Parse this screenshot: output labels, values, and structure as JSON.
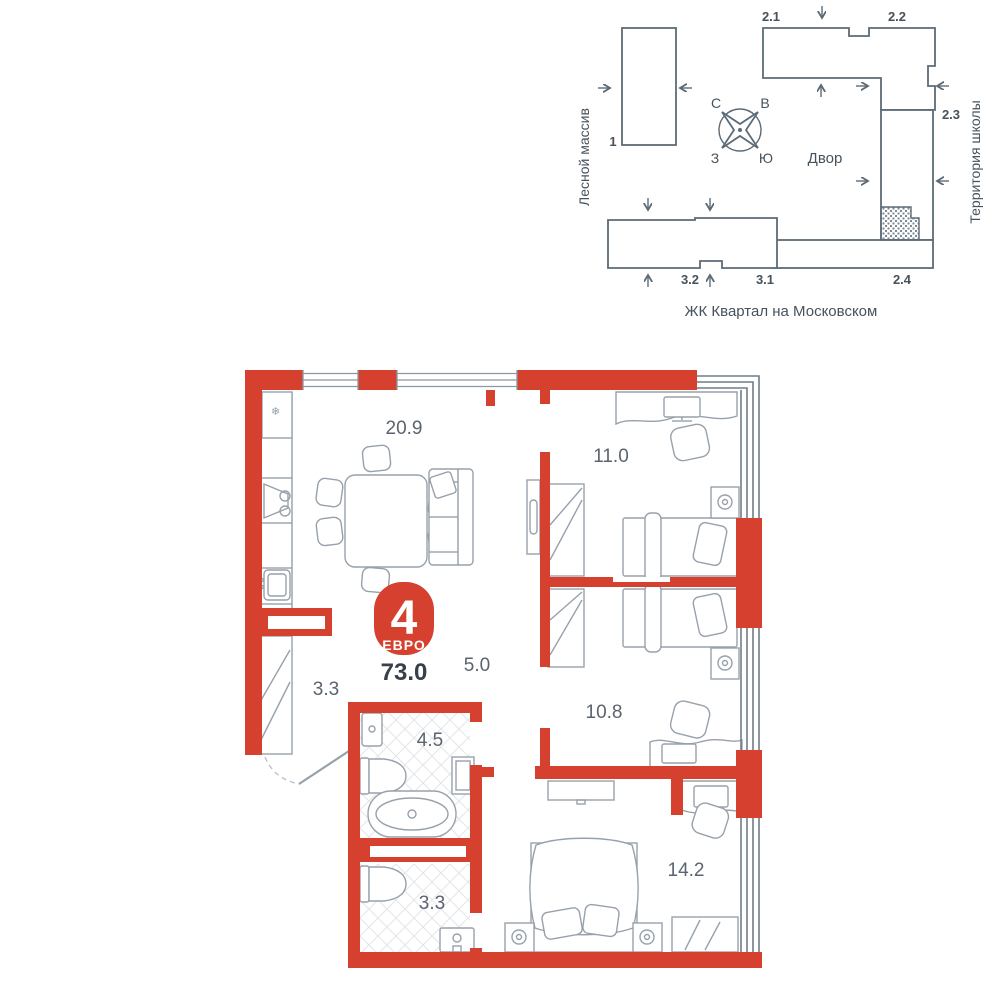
{
  "site_plan": {
    "buildings": {
      "b1": "1",
      "b2_1": "2.1",
      "b2_2": "2.2",
      "b2_3": "2.3",
      "b2_4": "2.4",
      "b3_1": "3.1",
      "b3_2": "3.2"
    },
    "compass": {
      "north": "С",
      "east": "В",
      "west": "З",
      "south": "Ю"
    },
    "labels": {
      "forest": "Лесной массив",
      "school": "Территория школы",
      "courtyard": "Двор",
      "complex": "ЖК Квартал на Московском"
    }
  },
  "floor_plan": {
    "badge": {
      "rooms_count": "4",
      "layout_type": "ЕВРО",
      "total_area": "73.0"
    },
    "areas": {
      "living_kitchen": "20.9",
      "bedroom_1": "11.0",
      "corridor": "5.0",
      "hallway": "3.3",
      "bathroom": "4.5",
      "bedroom_2": "10.8",
      "wc": "3.3",
      "bedroom_3": "14.2"
    },
    "fridge_symbol": "❄"
  },
  "colors": {
    "wall_red": "#d6402e",
    "site_outline": "#5c6b77",
    "furniture_line": "#97a1ab",
    "text_dark": "#46525c",
    "text_area": "#5b646e"
  }
}
